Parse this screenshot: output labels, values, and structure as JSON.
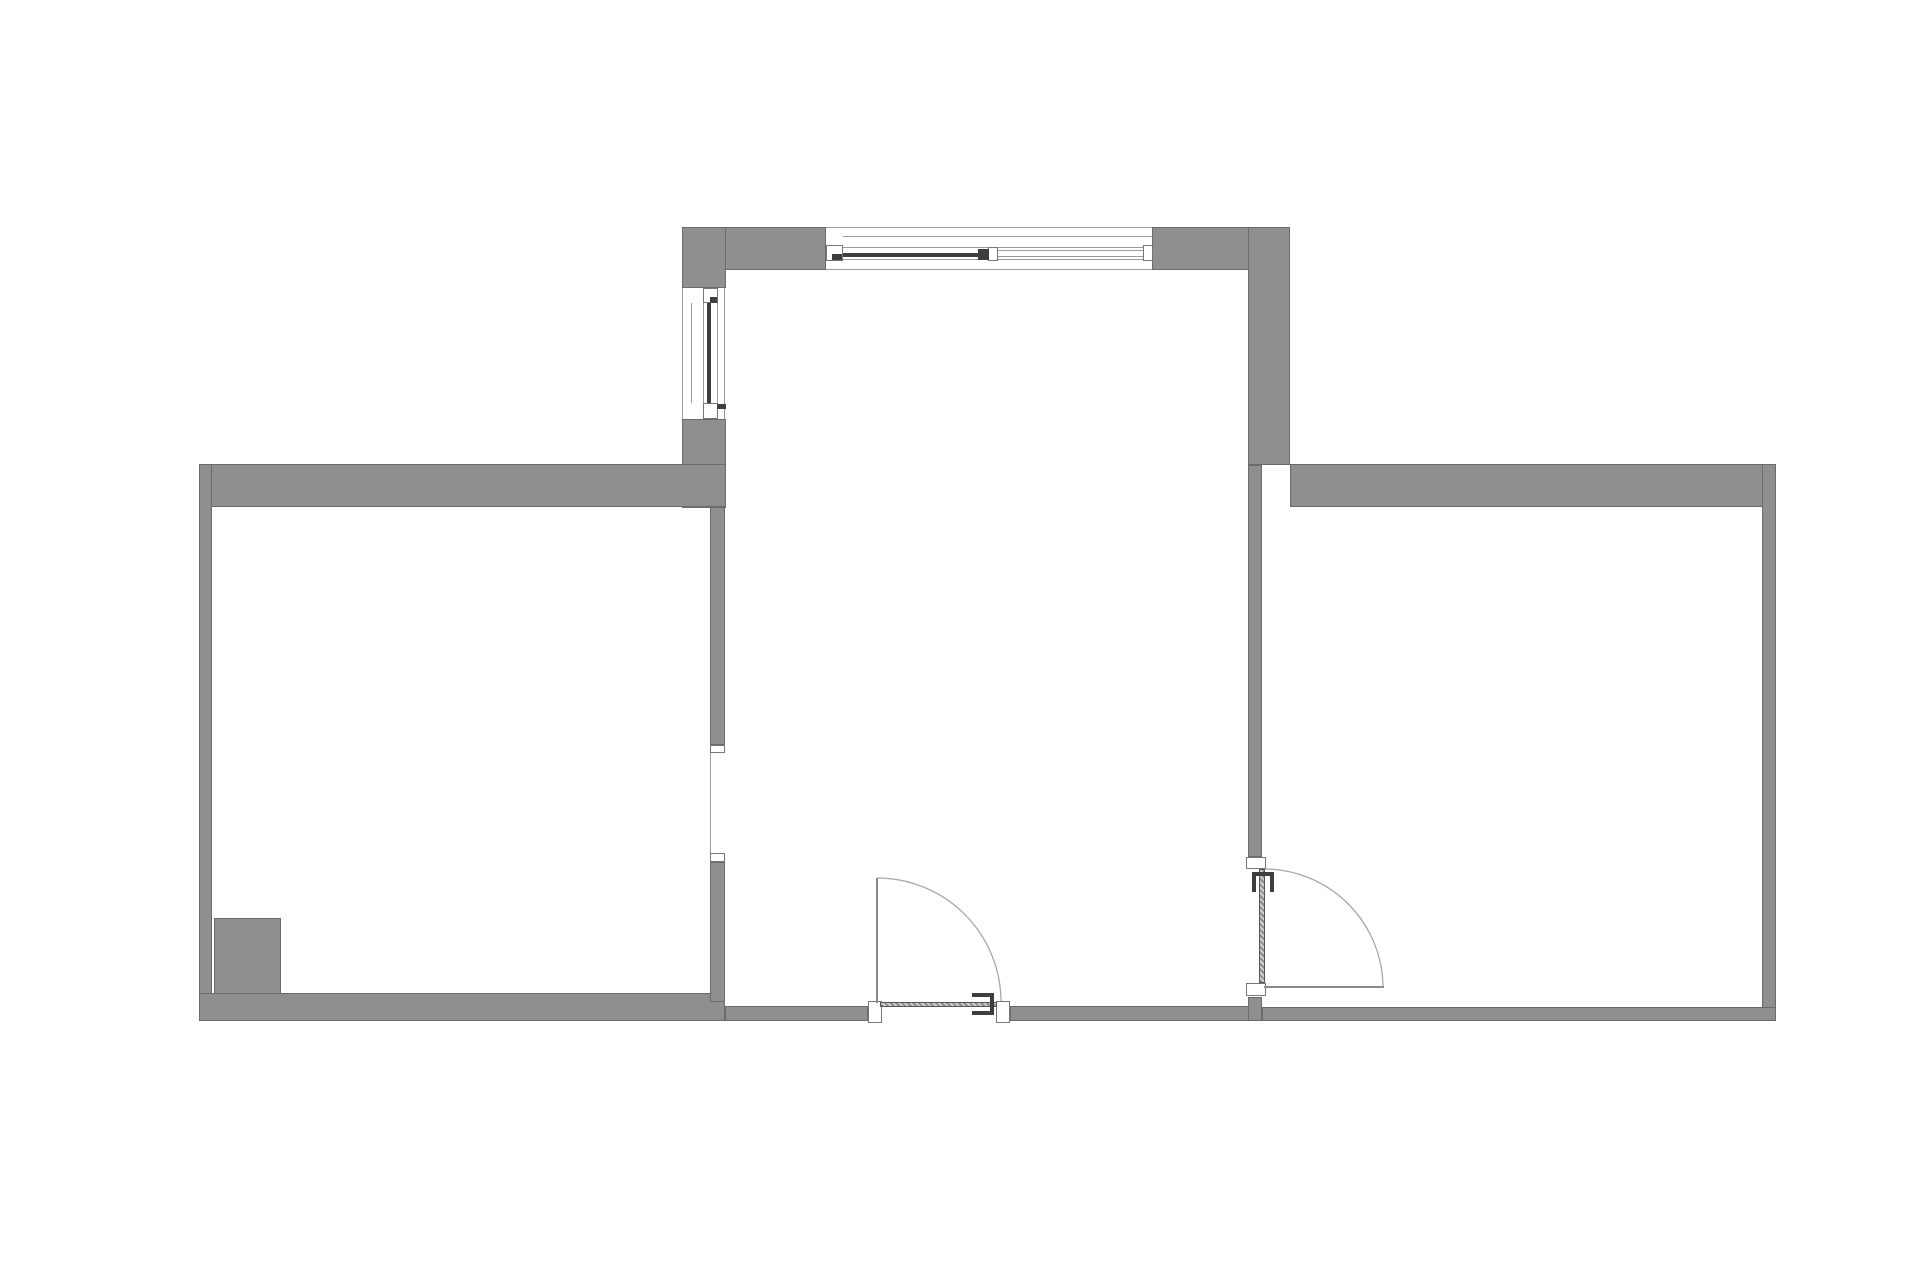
{
  "page": {
    "title": "apartment-floor-plan",
    "description": "2D architectural floor plan, three rooms, no text labels"
  },
  "canvas": {
    "width": 1920,
    "height": 1280,
    "background": "#ffffff"
  },
  "palette": {
    "wall_fill": "#8f8f90",
    "wall_outline": "#6b6b6b",
    "frame_outline": "#767676",
    "glazing_dark": "#3e3e3e",
    "thin_line": "#9b9b9b",
    "arc_line": "#a8a8a8"
  },
  "plan": {
    "rooms": [
      {
        "name": "left-room"
      },
      {
        "name": "central-room"
      },
      {
        "name": "right-room"
      }
    ],
    "walls": [
      {
        "name": "top-wall-left-segment",
        "x": 682,
        "y": 227,
        "w": 144,
        "h": 43
      },
      {
        "name": "top-wall-right-segment",
        "x": 1152,
        "y": 227,
        "w": 138,
        "h": 43
      },
      {
        "name": "central-left-wall-upper",
        "x": 682,
        "y": 227,
        "w": 44,
        "h": 61
      },
      {
        "name": "central-left-wall-mid",
        "x": 682,
        "y": 419,
        "w": 44,
        "h": 89
      },
      {
        "name": "central-right-wall-upper",
        "x": 1248,
        "y": 227,
        "w": 42,
        "h": 238
      },
      {
        "name": "left-room-top-wall",
        "x": 199,
        "y": 464,
        "w": 527,
        "h": 43
      },
      {
        "name": "right-room-top-wall",
        "x": 1290,
        "y": 464,
        "w": 486,
        "h": 43
      },
      {
        "name": "left-exterior-wall",
        "x": 199,
        "y": 464,
        "w": 13,
        "h": 557
      },
      {
        "name": "right-exterior-wall",
        "x": 1762,
        "y": 464,
        "w": 14,
        "h": 557
      },
      {
        "name": "bottom-wall-left-room",
        "x": 199,
        "y": 993,
        "w": 526,
        "h": 28
      },
      {
        "name": "bottom-wall-central-left",
        "x": 725,
        "y": 1006,
        "w": 143,
        "h": 15
      },
      {
        "name": "bottom-wall-central-right",
        "x": 1010,
        "y": 1006,
        "w": 252,
        "h": 15
      },
      {
        "name": "bottom-wall-right-room",
        "x": 1262,
        "y": 1007,
        "w": 514,
        "h": 14
      },
      {
        "name": "left-partition-upper",
        "x": 710,
        "y": 507,
        "w": 15,
        "h": 238
      },
      {
        "name": "left-partition-lower",
        "x": 710,
        "y": 862,
        "w": 15,
        "h": 140
      },
      {
        "name": "right-partition-upper",
        "x": 1248,
        "y": 465,
        "w": 14,
        "h": 392
      },
      {
        "name": "right-partition-lower",
        "x": 1248,
        "y": 997,
        "w": 14,
        "h": 24
      },
      {
        "name": "column-block",
        "x": 214,
        "y": 918,
        "w": 67,
        "h": 76
      }
    ],
    "frames": [
      {
        "name": "top-window-end-frame-left",
        "x": 826,
        "y": 245,
        "w": 17,
        "h": 16
      },
      {
        "name": "top-window-end-frame-right",
        "x": 1143,
        "y": 245,
        "w": 10,
        "h": 16
      },
      {
        "name": "top-window-mullion-step",
        "x": 988,
        "y": 247,
        "w": 10,
        "h": 14
      },
      {
        "name": "left-window-frame-top",
        "x": 703,
        "y": 288,
        "w": 15,
        "h": 15
      },
      {
        "name": "left-window-frame-bottom",
        "x": 703,
        "y": 403,
        "w": 15,
        "h": 16
      },
      {
        "name": "left-opening-jamb-top",
        "x": 710,
        "y": 745,
        "w": 15,
        "h": 8
      },
      {
        "name": "left-opening-jamb-bottom",
        "x": 710,
        "y": 853,
        "w": 15,
        "h": 9
      },
      {
        "name": "center-door-jamb-left",
        "x": 868,
        "y": 1001,
        "w": 14,
        "h": 22
      },
      {
        "name": "center-door-jamb-right",
        "x": 996,
        "y": 1001,
        "w": 14,
        "h": 22
      },
      {
        "name": "right-door-jamb-top",
        "x": 1246,
        "y": 857,
        "w": 20,
        "h": 12
      },
      {
        "name": "right-door-jamb-bottom",
        "x": 1246,
        "y": 983,
        "w": 20,
        "h": 13
      }
    ],
    "marks": [
      {
        "name": "top-window-glazing",
        "x": 843,
        "y": 253,
        "w": 137,
        "h": 4
      },
      {
        "name": "top-window-mullion-dark",
        "x": 978,
        "y": 249,
        "w": 11,
        "h": 11
      },
      {
        "name": "top-window-left-latch",
        "x": 832,
        "y": 254,
        "w": 10,
        "h": 6
      },
      {
        "name": "left-window-glazing",
        "x": 707,
        "y": 303,
        "w": 4,
        "h": 100
      },
      {
        "name": "left-window-top-latch",
        "x": 710,
        "y": 297,
        "w": 7,
        "h": 6
      },
      {
        "name": "left-window-handle",
        "x": 717,
        "y": 404,
        "w": 9,
        "h": 5
      },
      {
        "name": "center-door-handle-top",
        "x": 972,
        "y": 993,
        "w": 22,
        "h": 4
      },
      {
        "name": "center-door-handle-bottom",
        "x": 972,
        "y": 1011,
        "w": 22,
        "h": 4
      },
      {
        "name": "center-door-handle-stem",
        "x": 990,
        "y": 993,
        "w": 4,
        "h": 22
      },
      {
        "name": "right-door-handle-left",
        "x": 1252,
        "y": 872,
        "w": 4,
        "h": 20
      },
      {
        "name": "right-door-handle-right",
        "x": 1270,
        "y": 872,
        "w": 4,
        "h": 20
      },
      {
        "name": "right-door-handle-bar",
        "x": 1252,
        "y": 872,
        "w": 22,
        "h": 4
      }
    ],
    "leaves_closed": [
      {
        "name": "center-door-leaf-closed",
        "x": 880,
        "y": 1002,
        "w": 117,
        "h": 5
      },
      {
        "name": "right-door-leaf-closed",
        "x": 1259,
        "y": 869,
        "w": 6,
        "h": 114
      }
    ],
    "leaves_open": [
      {
        "name": "center-door-leaf-open",
        "x": 876,
        "y": 878,
        "w": 2,
        "h": 125
      },
      {
        "name": "right-door-leaf-open",
        "x": 1264,
        "y": 986,
        "w": 120,
        "h": 2
      }
    ],
    "lines": [
      {
        "name": "top-window-outer-face",
        "x": 826,
        "y": 227,
        "w": 326,
        "h": 1
      },
      {
        "name": "top-window-sill-line",
        "x": 843,
        "y": 236,
        "w": 309,
        "h": 1
      },
      {
        "name": "top-window-inner-face",
        "x": 826,
        "y": 269,
        "w": 326,
        "h": 1
      },
      {
        "name": "top-window-frame-line-a",
        "x": 843,
        "y": 247,
        "w": 300,
        "h": 1
      },
      {
        "name": "top-window-frame-line-b",
        "x": 843,
        "y": 259,
        "w": 300,
        "h": 1
      },
      {
        "name": "top-window-pane2-line-a",
        "x": 998,
        "y": 250,
        "w": 145,
        "h": 1
      },
      {
        "name": "top-window-pane2-line-b",
        "x": 998,
        "y": 256,
        "w": 145,
        "h": 1
      },
      {
        "name": "left-window-outer-face",
        "x": 682,
        "y": 288,
        "w": 1,
        "h": 131
      },
      {
        "name": "left-window-sill-line",
        "x": 691,
        "y": 303,
        "w": 1,
        "h": 100
      },
      {
        "name": "left-window-inner-face",
        "x": 724,
        "y": 288,
        "w": 1,
        "h": 131
      },
      {
        "name": "left-window-frame-line-a",
        "x": 703,
        "y": 303,
        "w": 1,
        "h": 100
      },
      {
        "name": "left-window-frame-line-b",
        "x": 717,
        "y": 303,
        "w": 1,
        "h": 100
      },
      {
        "name": "left-opening-face-line",
        "x": 710,
        "y": 753,
        "w": 1,
        "h": 100
      }
    ],
    "arcs": [
      {
        "name": "center-door-swing-arc",
        "d": "M 877 878 A 124 124 0 0 1 1001 1002"
      },
      {
        "name": "right-door-swing-arc",
        "d": "M 1264 869 A 119 119 0 0 1 1383 988"
      }
    ]
  }
}
